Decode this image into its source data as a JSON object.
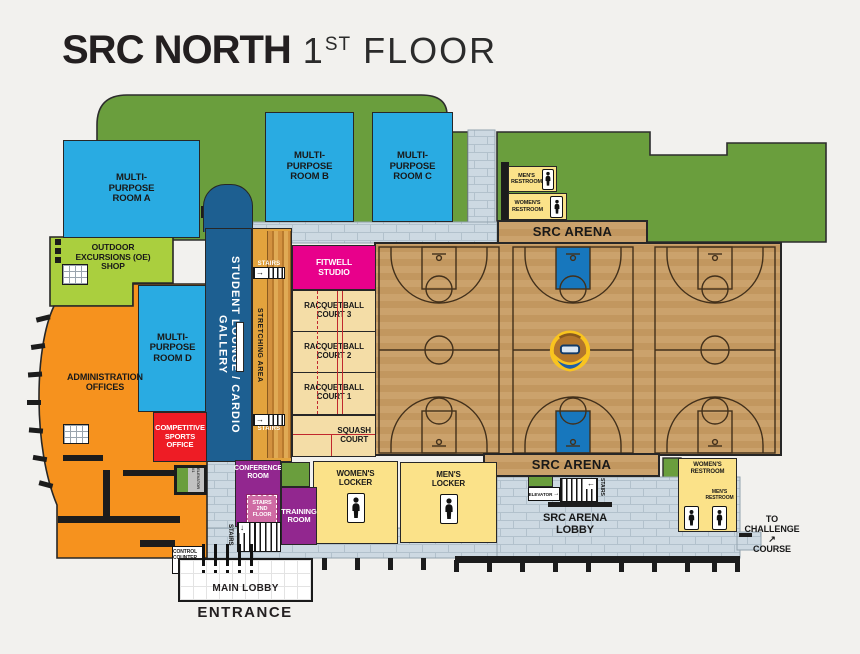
{
  "title": {
    "brand": "SRC NORTH",
    "floor_number": "1",
    "floor_ordinal": "ST",
    "floor_word": "FLOOR"
  },
  "colors": {
    "background": "#f2f1ee",
    "room_blue": "#29abe2",
    "lounge_blue": "#1d5f91",
    "green": "#6a9e3d",
    "lime": "#aacf3e",
    "orange": "#f6921e",
    "gold": "#e3a33d",
    "red": "#ee1c25",
    "magenta": "#e8008b",
    "purple": "#92278f",
    "yellow": "#fbe289",
    "wood": "#cba26c",
    "court_tan": "#f4dda7",
    "walkway_stone": "#cdd9e2",
    "key_blue": "#1777bd"
  },
  "rooms": {
    "multipurpose_a": {
      "l1": "MULTI-",
      "l2": "PURPOSE",
      "l3": "ROOM A"
    },
    "multipurpose_b": {
      "l1": "MULTI-",
      "l2": "PURPOSE",
      "l3": "ROOM B"
    },
    "multipurpose_c": {
      "l1": "MULTI-",
      "l2": "PURPOSE",
      "l3": "ROOM C"
    },
    "multipurpose_d": {
      "l1": "MULTI-",
      "l2": "PURPOSE",
      "l3": "ROOM D"
    },
    "oe_shop": {
      "l1": "OUTDOOR",
      "l2": "EXCURSIONS (OE)",
      "l3": "SHOP"
    },
    "admin": {
      "l1": "ADMINISTRATION",
      "l2": "OFFICES"
    },
    "student_lounge": {
      "label": "STUDENT LOUNGE / CARDIO GALLERY"
    },
    "stretching": {
      "label": "STRETCHING AREA"
    },
    "competitive": {
      "l1": "COMPETITIVE",
      "l2": "SPORTS",
      "l3": "OFFICE"
    },
    "fitwell": {
      "l1": "FITWELL",
      "l2": "STUDIO"
    },
    "racquetball3": {
      "l1": "RACQUETBALL",
      "l2": "COURT 3"
    },
    "racquetball2": {
      "l1": "RACQUETBALL",
      "l2": "COURT 2"
    },
    "racquetball1": {
      "l1": "RACQUETBALL",
      "l2": "COURT 1"
    },
    "squash": {
      "l1": "SQUASH",
      "l2": "COURT"
    },
    "conference": {
      "l1": "CONFERENCE",
      "l2": "ROOM"
    },
    "stairs_2nd_floor": {
      "l1": "STAIRS",
      "l2": "2ND",
      "l3": "FLOOR"
    },
    "training": {
      "l1": "TRAINING",
      "l2": "ROOM"
    },
    "womens_locker": {
      "l1": "WOMEN'S",
      "l2": "LOCKER"
    },
    "mens_locker": {
      "l1": "MEN'S",
      "l2": "LOCKER"
    },
    "mens_restroom_nw": {
      "l1": "MEN'S",
      "l2": "RESTROOM"
    },
    "womens_restroom_nw": {
      "l1": "WOMEN'S",
      "l2": "RESTROOM"
    },
    "womens_restroom_se": {
      "l1": "WOMEN'S",
      "l2": "RESTROOM"
    },
    "mens_restroom_se": {
      "l1": "MEN'S",
      "l2": "RESTROOM"
    },
    "arena_lobby": {
      "l1": "SRC ARENA",
      "l2": "LOBBY"
    },
    "control_counter": {
      "l1": "CONTROL",
      "l2": "COUNTER"
    },
    "main_lobby": {
      "label": "MAIN LOBBY"
    }
  },
  "arena": {
    "label_top": "SRC ARENA",
    "label_bottom": "SRC ARENA"
  },
  "labels": {
    "entrance": "ENTRANCE",
    "stairs": "STAIRS",
    "elevator": "ELEVATOR",
    "elevator_1": "ELEVATOR #1",
    "challenge": {
      "l1": "TO",
      "l2": "CHALLENGE",
      "l3": "COURSE",
      "arrow": "↗"
    }
  }
}
